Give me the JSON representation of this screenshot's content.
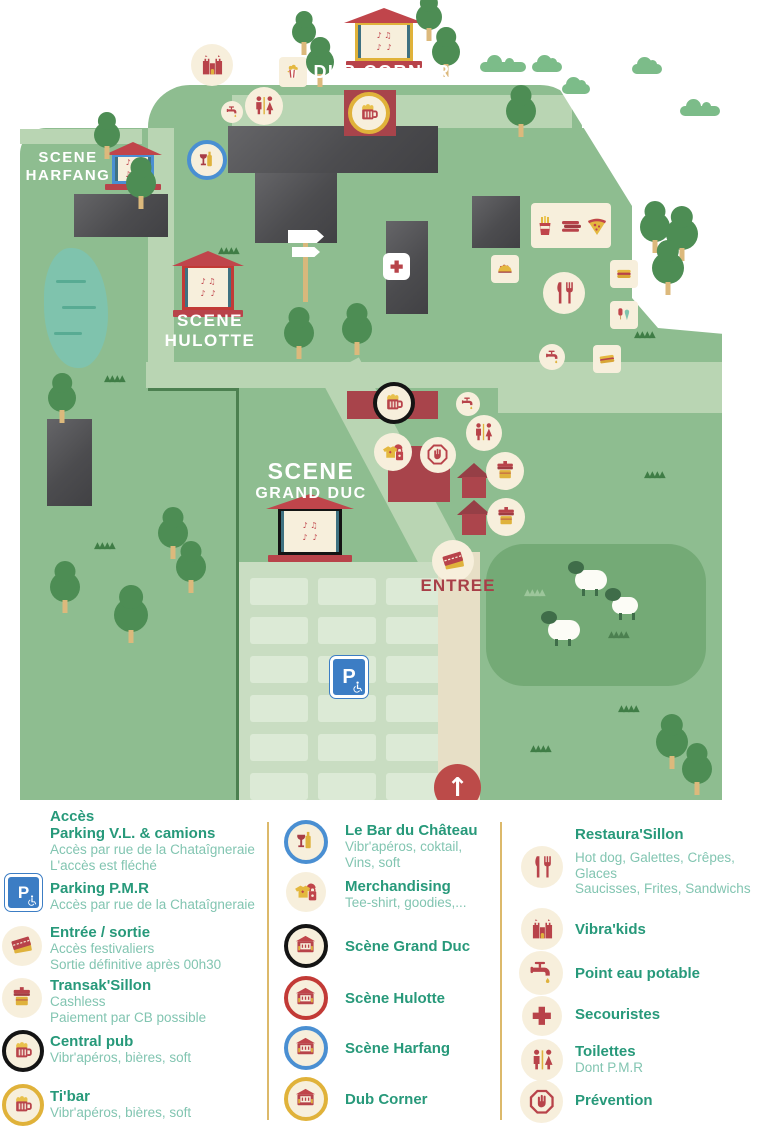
{
  "map": {
    "labels": {
      "dub_corner": "DUB CORNER",
      "harfang_line1": "SCENE",
      "harfang_line2": "HARFANG",
      "hulotte_line1": "SCENE",
      "hulotte_line2": "HULOTTE",
      "grand_duc_line1": "SCENE",
      "grand_duc_line2": "GRAND DUC",
      "entree": "ENTREE",
      "parking_sign": "P"
    },
    "colors": {
      "grass": "#8ebd90",
      "path_light": "#b9d5b3",
      "path_tan": "#e7dfc6",
      "field_dark": "#74aa76",
      "cream": "#f7efdc",
      "accent_red": "#b8434a",
      "ring_blue": "#4a8fd2",
      "ring_yellow": "#e0b23a",
      "ring_red": "#c23a36",
      "ring_black": "#1a1a1a",
      "legend_title_green": "#27997a",
      "legend_sub_green": "#82c5b1"
    }
  },
  "legend": {
    "columns": [
      {
        "items": [
          {
            "title": "Accès",
            "title2": "Parking V.L. & camions",
            "sub1": "Accès par rue de la Chataîgneraie",
            "sub2": "L'accès est fléché",
            "icon": "none"
          },
          {
            "title": "Parking P.M.R",
            "sub1": "Accès par rue de la Chataîgneraie",
            "icon": "parking-pmr"
          },
          {
            "title": "Entrée / sortie",
            "sub1": "Accès festivaliers",
            "sub2": "Sortie définitive après 00h30",
            "icon": "ticket"
          },
          {
            "title": "Transak'Sillon",
            "sub1": "Cashless",
            "sub2": "Paiement par CB possible",
            "icon": "cashless-booth"
          },
          {
            "title": "Central pub",
            "sub1": "Vibr'apéros, bières, soft",
            "icon": "beer-black-ring"
          },
          {
            "title": "Ti'bar",
            "sub1": "Vibr'apéros, bières, soft",
            "icon": "beer-yellow-ring"
          }
        ]
      },
      {
        "items": [
          {
            "title": "Le Bar du Château",
            "sub1": "Vibr'apéros, coktail,",
            "sub2": "Vins, soft",
            "icon": "wine-blue-ring"
          },
          {
            "title": "Merchandising",
            "sub1": "Tee-shirt, goodies,...",
            "icon": "merchandising"
          },
          {
            "title": "Scène Grand Duc",
            "icon": "stage-black-ring"
          },
          {
            "title": "Scène Hulotte",
            "icon": "stage-red-ring"
          },
          {
            "title": "Scène Harfang",
            "icon": "stage-blue-ring"
          },
          {
            "title": "Dub Corner",
            "icon": "stage-yellow-ring"
          }
        ]
      },
      {
        "items": [
          {
            "title": "Restaura'Sillon",
            "sub1": "Hot dog, Galettes, Crêpes, Glaces",
            "sub2": "Saucisses, Frites, Sandwichs",
            "icon": "cutlery"
          },
          {
            "title": "Vibra'kids",
            "icon": "kids-castle"
          },
          {
            "title": "Point eau potable",
            "icon": "water-tap"
          },
          {
            "title": "Secouristes",
            "icon": "first-aid-cross"
          },
          {
            "title": "Toilettes",
            "sub1": "Dont P.M.R",
            "icon": "toilets"
          },
          {
            "title": "Prévention",
            "icon": "prevention-hand"
          }
        ]
      }
    ]
  }
}
